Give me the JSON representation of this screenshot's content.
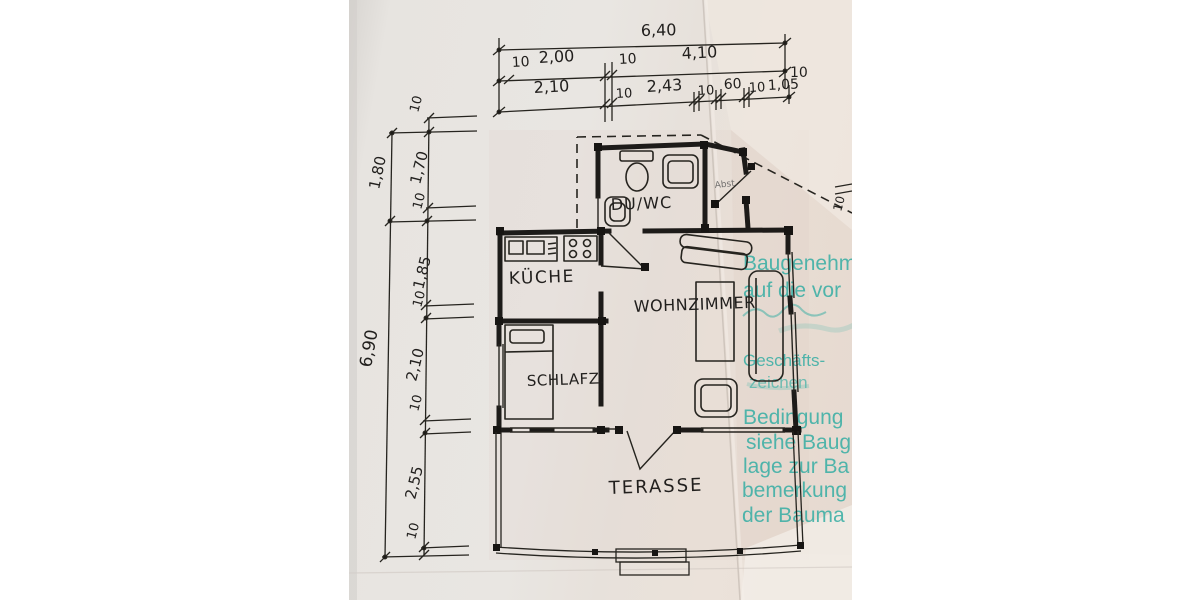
{
  "document": {
    "type_label": "floor-plan-scan",
    "colors": {
      "paper": "#e8e4e0",
      "ink": "#211f1d",
      "stamp_teal": "#3bafa5"
    }
  },
  "rooms": {
    "duwc": "DU/WC",
    "kueche": "KÜCHE",
    "wohnzimmer": "WOHNZIMMER",
    "schlafz": "SCHLAFZ.",
    "terasse": "TERASSE"
  },
  "entry_note": "Abst.",
  "dims": {
    "total_width": "6,40",
    "row2": {
      "d1": "10",
      "d2": "2,00",
      "d3": "10",
      "d4": "4,10",
      "d5": "10"
    },
    "row3": {
      "d1": "2,10",
      "d2": "10",
      "d3": "2,43",
      "d4": "10",
      "d5": "60",
      "d6": "10",
      "d7": "1,05"
    },
    "left_outer": {
      "seg": "1,80",
      "total": "6,90"
    },
    "left_inner": {
      "d1": "10",
      "d2": "1,70",
      "d3": "10",
      "d4": "1,85",
      "d5": "10",
      "d6": "2,10",
      "d7": "10",
      "d8": "2,55",
      "d9": "10"
    },
    "right_side": {
      "d1": "10"
    }
  },
  "stamp": {
    "lines": [
      "Baugenehm",
      "auf die vor",
      "Geschäfts-",
      "zeichen",
      "Bedingung",
      "siehe Baug",
      "lage zur Ba",
      "bemerkung",
      "der Bauma"
    ]
  }
}
